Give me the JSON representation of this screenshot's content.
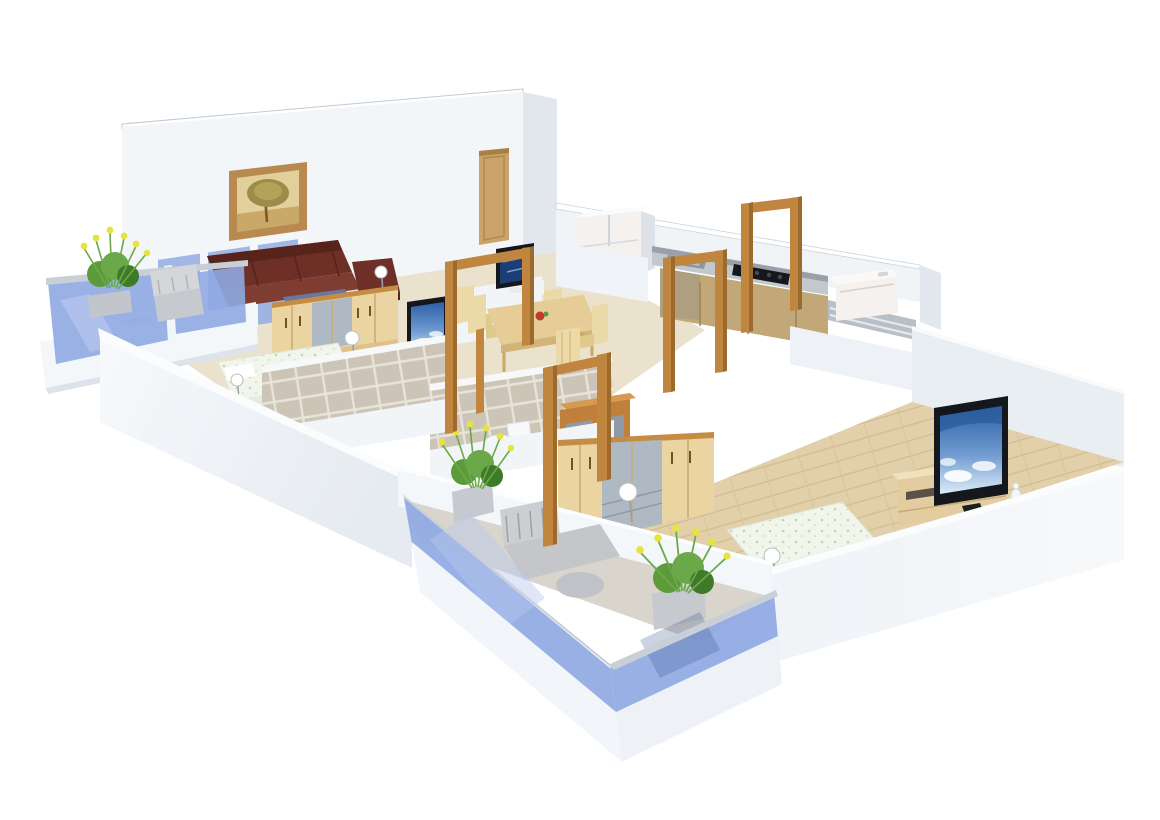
{
  "meta": {
    "title": "3D cutaway floor plan render of a 2BHK apartment, isometric view on white background",
    "background": "#ffffff"
  },
  "palette": {
    "wall_front": "#f3f6f9",
    "wall_side": "#e4e9ef",
    "wall_cap": "#fbfcfe",
    "wall_shadow": "#d9dfe7",
    "floor_beige": "#eae2cd",
    "floor_wood": "#e2d0ab",
    "tile": "#ccc4b6",
    "tile_grout": "#e9e4da",
    "glass_blue": "#8fa9e2",
    "glass_rail": "#c9cfd7",
    "frame_wood": "#c08640",
    "frame_wood_dark": "#9c6a2c",
    "wardrobe_wood": "#ead4a2",
    "wardrobe_trim": "#c58c44",
    "mirror_gray": "#aeb9c4",
    "sofa_maroon": "#6e2f26",
    "sofa_maroon_dark": "#58231b",
    "coffee_table_blue": "#68789f",
    "dining_wood": "#e6cd97",
    "chair_wood": "#ecd9a8",
    "counter_top": "#c3c8ce",
    "counter_splash": "#9aa0a8",
    "cabinet_wood": "#c2a878",
    "appliance_white": "#f4f1ee",
    "tv_frame": "#14171c",
    "tv_sky_top": "#2e5fa8",
    "tv_sky_bottom": "#dcebf7",
    "plant_green": "#5d9a3a",
    "plant_green_dark": "#3f7a28",
    "flower_yellow": "#e8e23e",
    "porcelain_white": "#f7f9fa",
    "fruit_red": "#c0392b",
    "art_frame": "#b98a50",
    "door_wood": "#caa36a"
  },
  "rooms": [
    {
      "name": "living-room",
      "furniture": [
        "maroon-l-shaped-sofa",
        "blue-coffee-table",
        "framed-tree-wall-art",
        "wood-entrance-door",
        "tv-on-divider-wall",
        "blue-glass-partition"
      ]
    },
    {
      "name": "living-balcony",
      "furniture": [
        "blue-glass-railing",
        "planter-with-yellow-flowers",
        "gray-outdoor-chair"
      ]
    },
    {
      "name": "bedroom-1",
      "furniture": [
        "wood-wardrobe-with-mirror",
        "double-bed-floral-linen",
        "tv-on-side-table",
        "ball-floor-lamps"
      ]
    },
    {
      "name": "bathroom-1",
      "furniture": [
        "beige-wall-tiles",
        "white-toilet"
      ]
    },
    {
      "name": "bathroom-2",
      "furniture": [
        "beige-wall-tiles",
        "wood-vanity-cabinet"
      ]
    },
    {
      "name": "dining-area",
      "furniture": [
        "wood-dining-table",
        "six-wood-chairs",
        "red-fruit-bowl",
        "white-refrigerator"
      ]
    },
    {
      "name": "kitchen",
      "furniture": [
        "gray-top-counter",
        "black-gas-hob",
        "steel-sink",
        "wood-base-cabinets"
      ]
    },
    {
      "name": "utility-balcony",
      "furniture": [
        "white-washing-machine",
        "gray-railing"
      ]
    },
    {
      "name": "master-bedroom",
      "furniture": [
        "long-wood-wardrobe-with-mirror",
        "low-bed-floral-linen",
        "wood-tv-unit",
        "flatscreen-tv-sky-image",
        "ball-floor-lamp",
        "white-vase"
      ]
    },
    {
      "name": "master-balcony",
      "furniture": [
        "blue-glass-railing",
        "gray-lounge-chair",
        "two-planters-with-yellow-flowers"
      ]
    }
  ],
  "open_door_frames_wood_count": 5
}
